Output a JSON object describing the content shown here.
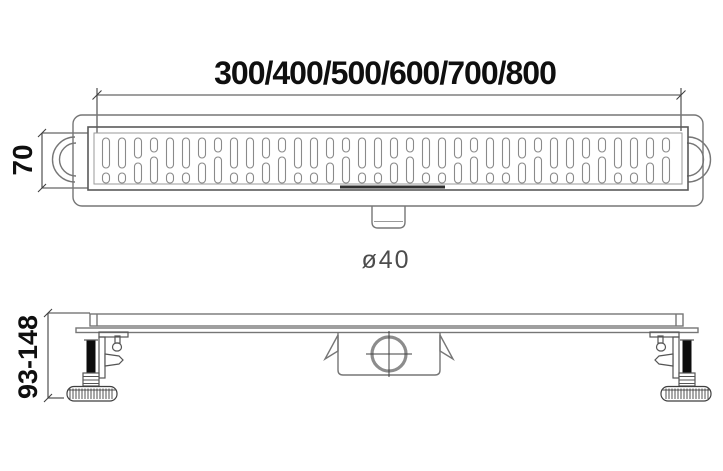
{
  "drawing": {
    "length_options_label": "300/400/500/600/700/800",
    "width_label": "70",
    "outlet_diameter_label": "ø40",
    "height_range_label": "93-148"
  },
  "grate": {
    "slot_columns": 36
  },
  "colors": {
    "line": "#767676",
    "dark": "#3f3f3f",
    "text": "#0f0f0f",
    "subtext": "#4c4c4c",
    "black": "#0c0c0c"
  }
}
